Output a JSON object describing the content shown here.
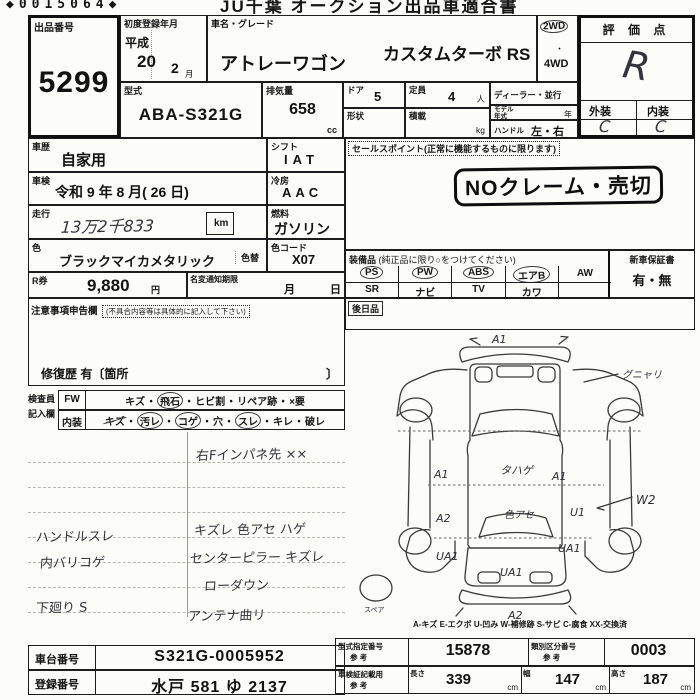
{
  "header": {
    "serial": "◆0015064◆",
    "title": "JU千葉 オークション出品車適合書"
  },
  "lot": {
    "label": "出品番号",
    "value": "5299"
  },
  "first_reg": {
    "label": "初度登録年月",
    "era": "平成",
    "year": "20",
    "month": "2",
    "month_unit": "月"
  },
  "vehicle": {
    "label": "車名・グレード",
    "name": "アトレーワゴン",
    "grade": "カスタムターボ RS"
  },
  "drive": {
    "two_wd": "2WD",
    "dot": "・",
    "four_wd": "4WD"
  },
  "score": {
    "label": "評 価 点",
    "value": "R",
    "exterior_label": "外装",
    "interior_label": "内装",
    "exterior": "C",
    "interior": "C"
  },
  "model": {
    "label": "型式",
    "value": "ABA-S321G"
  },
  "displacement": {
    "label": "排気量",
    "value": "658",
    "unit": "cc"
  },
  "doors": {
    "label": "ドア",
    "value": "5"
  },
  "capacity": {
    "label": "定員",
    "value": "4",
    "unit": "人"
  },
  "shape": {
    "label": "形状",
    "value": ""
  },
  "load": {
    "label": "積載",
    "unit": "kg"
  },
  "dealer": {
    "label": "ディーラー・並行"
  },
  "model_year": {
    "label1": "モデル",
    "label2": "年式",
    "unit": "年"
  },
  "steering": {
    "label": "ハンドル",
    "value": "左・右"
  },
  "history": {
    "label": "車歴",
    "value": "自家用"
  },
  "shaken": {
    "label": "車検",
    "value": "令和 9 年 8 月( 26 日)"
  },
  "mileage": {
    "label": "走行",
    "value": "13万2千833",
    "unit": "km"
  },
  "shift": {
    "label": "シフト",
    "value": "IAT"
  },
  "cooling": {
    "label": "冷房",
    "value": "AAC"
  },
  "fuel": {
    "label": "燃料",
    "value": "ガソリン"
  },
  "color": {
    "label": "色",
    "value": "ブラックマイカメタリック",
    "change_label": "色替",
    "code_label": "色コード",
    "code": "X07"
  },
  "r_ticket": {
    "label": "R券",
    "value": "9,880",
    "unit": "円"
  },
  "name_change": {
    "label": "名変通知期限",
    "month_unit": "月",
    "day_unit": "日"
  },
  "sales_point": {
    "label": "セールスポイント(正常に機能するものに限ります)",
    "stamp": "NOクレーム・売切"
  },
  "notice": {
    "label": "注意事項申告欄",
    "sublabel": "(不具合内容等は具体的に記入して下さい)",
    "repair_history": "修復歴 有〔箇所",
    "bracket_close": "〕"
  },
  "equipment": {
    "label": "装備品",
    "sublabel": "(純正品に限り○をつけてください)",
    "row1": [
      "PS",
      "PW",
      "ABS",
      "エアB",
      "AW"
    ],
    "row2": [
      "SR",
      "ナビ",
      "TV",
      "カワ",
      ""
    ],
    "warranty_label": "新車保証書",
    "warranty_value": "有・無",
    "later_label": "後日品"
  },
  "inspector": {
    "label1": "検査員",
    "label2": "記入欄",
    "sep": "・",
    "fw": {
      "label": "FW",
      "items": [
        "キズ",
        "飛石",
        "ヒビ割",
        "リペア跡",
        "×要"
      ]
    },
    "interior": {
      "label": "内装",
      "items": [
        "キズ",
        "汚レ",
        "コゲ",
        "穴",
        "スレ",
        "キレ",
        "破レ"
      ]
    }
  },
  "notes": {
    "right_top": "右Fインパネ先 ××",
    "left1": "ハンドルスレ",
    "left2": "内バリコゲ",
    "left3": "下廻り S",
    "right1": "キズレ 色アセ ハゲ",
    "right2": "センターピラー キズレ",
    "right3": "ローダウン",
    "right4": "アンテナ曲リ"
  },
  "diagram": {
    "front_bumper": "A1",
    "pillar_note": "グニャリ",
    "roof_left": "A1",
    "roof_center": "タハゲ",
    "roof_right": "A1",
    "mid_left": "A2",
    "rear_glass_note": "色アセ",
    "mid_right": "U1",
    "side_note": "W2",
    "rear_left": "UA1",
    "rear_right": "UA1",
    "rear_center": "UA1",
    "rear_bumper": "A2",
    "spare": "スペア",
    "legend": "A-キズ  E-エクボ  U-凹み  W-補修跡  S-サビ  C-腐食  XX-交換済"
  },
  "chassis": {
    "label": "車台番号",
    "value": "S321G-0005952"
  },
  "registration": {
    "label": "登録番号",
    "value": "水戸 581 ゆ 2137"
  },
  "type_no": {
    "label": "型式指定番号",
    "ref": "参 考",
    "value": "15878"
  },
  "class_no": {
    "label": "類別区分番号",
    "ref": "参 考",
    "value": "0003"
  },
  "dims": {
    "label": "車検証記載用",
    "ref": "参 考",
    "length_label": "長さ",
    "length": "339",
    "width_label": "幅",
    "width": "147",
    "height_label": "高さ",
    "height": "187",
    "unit": "cm"
  }
}
